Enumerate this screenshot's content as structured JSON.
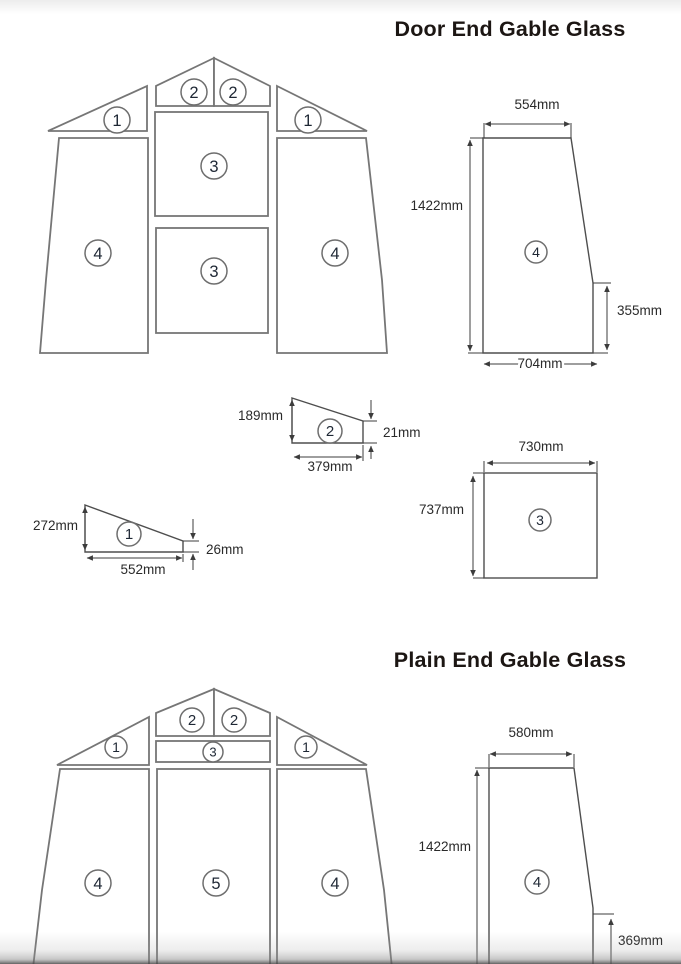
{
  "door_end": {
    "title": "Door End Gable Glass",
    "gable": {
      "top_triangles": [
        "2",
        "2"
      ],
      "side_triangles": [
        "1",
        "1"
      ],
      "center_panels": [
        "3",
        "3"
      ],
      "side_panels": [
        "4",
        "4"
      ]
    },
    "detail_4": {
      "label": "4",
      "top_width": "554mm",
      "height": "1422mm",
      "right_step": "355mm",
      "bottom_width": "704mm"
    },
    "detail_2": {
      "label": "2",
      "left_height": "189mm",
      "right_height": "21mm",
      "width": "379mm"
    },
    "detail_1": {
      "label": "1",
      "left_height": "272mm",
      "right_height": "26mm",
      "width": "552mm"
    },
    "detail_3": {
      "label": "3",
      "width": "730mm",
      "height": "737mm"
    }
  },
  "plain_end": {
    "title": "Plain End Gable Glass",
    "gable": {
      "top_triangles": [
        "2",
        "2"
      ],
      "side_triangles": [
        "1",
        "1"
      ],
      "top_strip": "3",
      "side_panels": [
        "4",
        "4"
      ],
      "center_panel": "5"
    },
    "detail_4": {
      "label": "4",
      "top_width": "580mm",
      "height": "1422mm",
      "right_step": "369mm"
    }
  },
  "colors": {
    "piece_outline": "#767676",
    "detail_outline": "#4e4e4e",
    "dimension": "#3c3c3c",
    "number": "#1e2734"
  }
}
